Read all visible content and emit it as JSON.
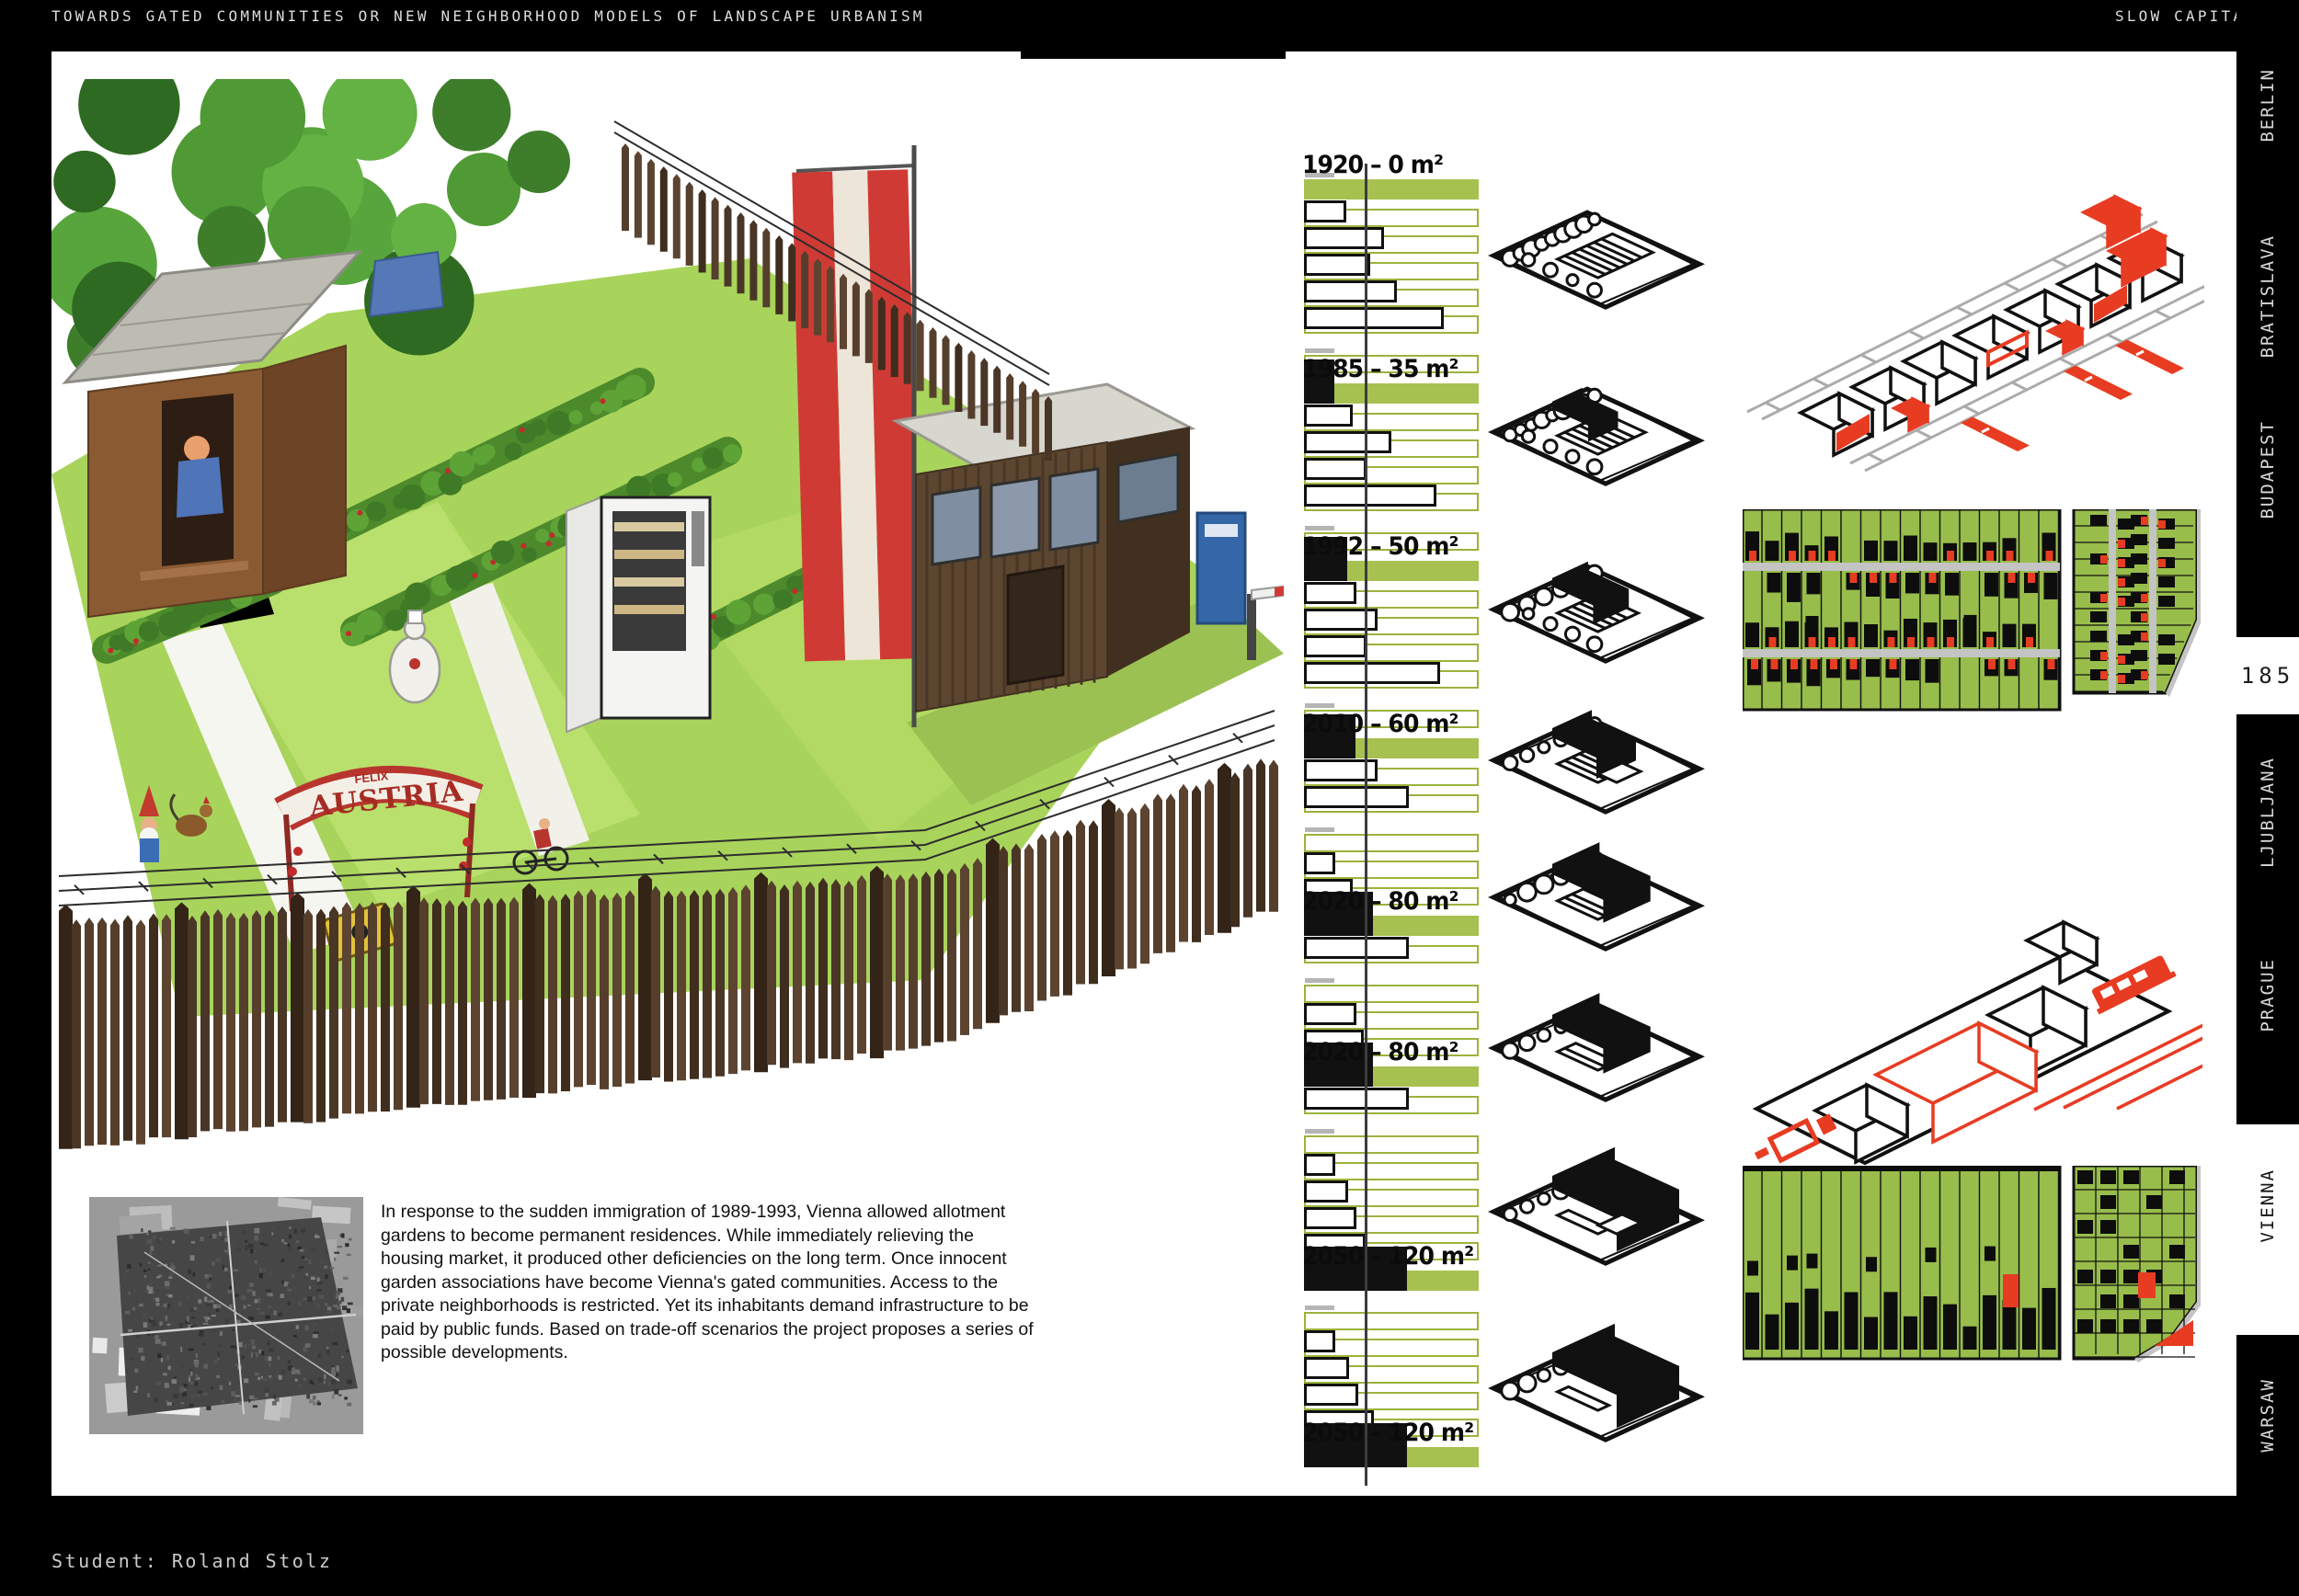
{
  "header": {
    "left_title": "TOWARDS GATED COMMUNITIES OR NEW NEIGHBORHOOD MODELS OF LANDSCAPE URBANISM",
    "right_title": "SLOW CAPITAL"
  },
  "footer": {
    "student_label": "Student: Roland Stolz"
  },
  "sidebar": {
    "page_number": "185",
    "cities": [
      {
        "label": "BERLIN",
        "active": false
      },
      {
        "label": "BRATISLAVA",
        "active": false
      },
      {
        "label": "BUDAPEST",
        "active": false
      },
      {
        "label": "LJUBLJANA",
        "active": false
      },
      {
        "label": "PRAGUE",
        "active": false
      },
      {
        "label": "VIENNA",
        "active": true
      },
      {
        "label": "WARSAW",
        "active": false
      }
    ]
  },
  "description": {
    "text": "In response to the sudden immigration of 1989-1993, Vienna allowed allotment gardens to become permanent residences. While immediately relieving the housing market, it produced other deficiencies on the long term. Once innocent garden associations have become Vienna's gated communities. Access to the private neighborhoods is restricted. Yet its inhabitants demand infrastructure to be paid by public funds.  Based on trade-off scenarios the project proposes a series of possible developments.",
    "years_mentioned": "1989-1993"
  },
  "garden_cartoon": {
    "arch_text": "AUSTRIA",
    "arch_text_small": "FELIX",
    "icons": [
      "austrian-flag-icon",
      "garden-shed-icon",
      "guard-kiosk-icon",
      "vending-machine-icon",
      "picket-fence-icon",
      "barbed-wire-icon",
      "garden-gnome-icon",
      "rooster-icon",
      "austria-arch-sign-icon",
      "boom-barrier-icon"
    ]
  },
  "aerial_photo": {
    "icon": "aerial-photo-allotment-district"
  },
  "chart_data": {
    "type": "bar",
    "orientation": "horizontal timeline of dwelling size milestones",
    "unit": "m²",
    "guide_line_frac": 0.345,
    "full_bar_value": 203,
    "milestones": [
      {
        "year": "1920",
        "area_m2": 0,
        "label": "1920 – 0 m²",
        "plot_icon": "allotment-garden-plot",
        "pre_rows": [],
        "post_rows": [
          0.24,
          0.46,
          0.38,
          0.53,
          0.8
        ]
      },
      {
        "year": "1985",
        "area_m2": 35,
        "label": "1985 – 35 m²",
        "plot_icon": "plot-with-shed",
        "pre_rows": [
          0
        ],
        "post_rows": [
          0.28,
          0.5,
          0.36,
          0.76
        ]
      },
      {
        "year": "1992",
        "area_m2": 50,
        "label": "1992 – 50 m²",
        "plot_icon": "plot-with-small-house",
        "pre_rows": [
          0
        ],
        "post_rows": [
          0.3,
          0.42,
          0.36,
          0.78
        ]
      },
      {
        "year": "2010",
        "area_m2": 60,
        "label": "2010 – 60 m²",
        "plot_icon": "plot-with-house-pool",
        "pre_rows": [
          0
        ],
        "post_rows": [
          0.42,
          0.6
        ]
      },
      {
        "year": "2020",
        "area_m2": 80,
        "label": "2020 – 80 m²",
        "plot_icon": "plot-with-larger-house",
        "pre_rows": [
          0,
          0.18,
          0.28
        ],
        "post_rows": [
          0.6
        ]
      },
      {
        "year": "2020",
        "area_m2": 80,
        "label": "2020 – 80 m²",
        "plot_icon": "plot-with-row-house",
        "pre_rows": [
          0,
          0.3,
          0.34
        ],
        "post_rows": [
          0.6
        ]
      },
      {
        "year": "2050",
        "area_m2": 120,
        "label": "2050 – 120 m²",
        "plot_icon": "plot-with-villa-pool",
        "pre_rows": [
          0,
          0.18,
          0.25,
          0.3,
          0.35
        ],
        "post_rows": []
      },
      {
        "year": "2050",
        "area_m2": 120,
        "label": "2050 – 120 m²",
        "plot_icon": "plot-with-large-house",
        "pre_rows": [
          0,
          0.18,
          0.26,
          0.31,
          0.4
        ],
        "post_rows": []
      }
    ]
  },
  "site_drawings": {
    "icons": [
      "isometric-street-row-drawing",
      "parcel-map-drawing",
      "isometric-block-red-tram-drawing",
      "parcel-map-drawing-2"
    ],
    "colors": {
      "green": "#98bd4b",
      "red": "#e73c22",
      "street_gray": "#c4c4c4",
      "line_black": "#111111"
    }
  }
}
